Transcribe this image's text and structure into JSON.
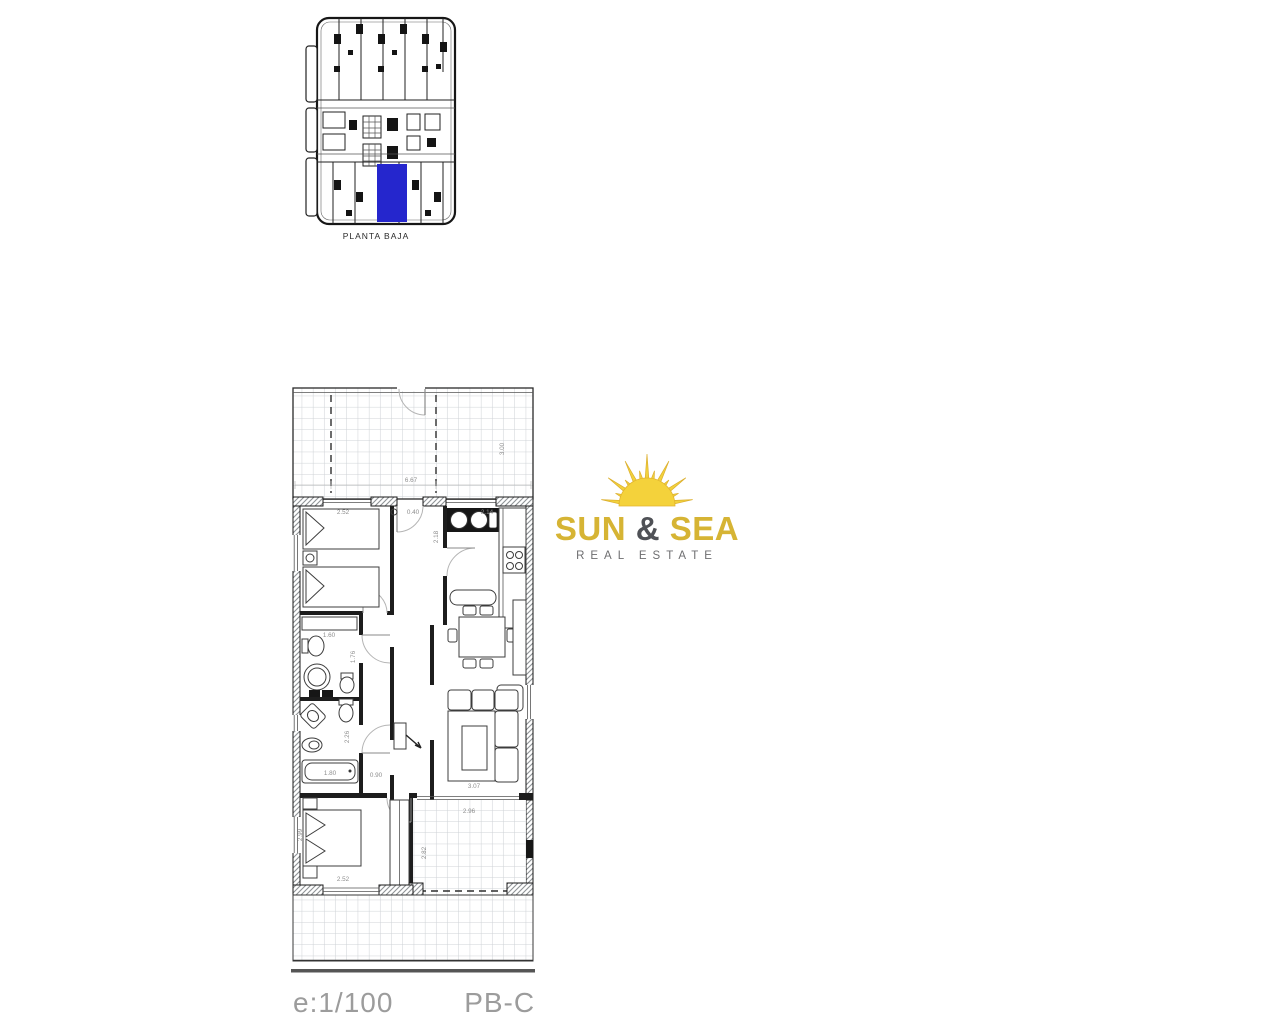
{
  "overview": {
    "caption": "PLANTA BAJA",
    "highlight_color": "#2526cd"
  },
  "logo": {
    "title_word1": "SUN",
    "title_amp": "&",
    "title_word2": "SEA",
    "subtitle": "REAL ESTATE",
    "gold": "#d6b434",
    "dark": "#4f5156"
  },
  "floorplan": {
    "dims": {
      "terrace_width": "6.67",
      "terrace_depth": "3.00",
      "bedroom1_width": "2.52",
      "entry_niche": "0.40",
      "kitchen_width": "2.14",
      "kitchen_depth": "2.18",
      "bath1_width": "1.60",
      "bath1_depth": "1.76",
      "bath2_depth": "2.26",
      "bathtub_length": "1.80",
      "hall_width": "0.90",
      "living_width": "3.07",
      "bedroom2_width": "2.52",
      "bedroom2_depth": "2.99",
      "terrace2_width": "2.96",
      "terrace2_depth": "2.82"
    }
  },
  "footer": {
    "scale": "e:1/100",
    "plan_code": "PB-C"
  }
}
